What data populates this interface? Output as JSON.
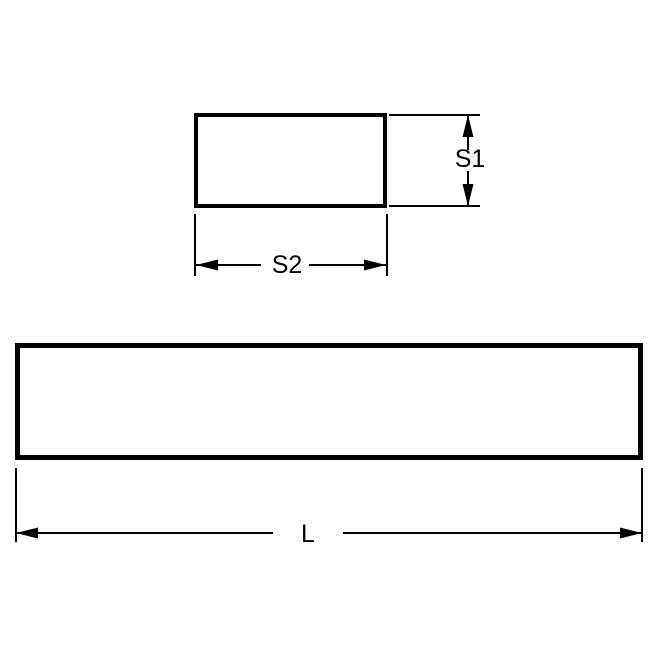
{
  "colors": {
    "line": "#000000",
    "background": "#ffffff"
  },
  "diagram": {
    "type": "engineering-dimension-drawing",
    "dimension_labels": {
      "s1": "S1",
      "s2": "S2",
      "l": "L"
    }
  }
}
